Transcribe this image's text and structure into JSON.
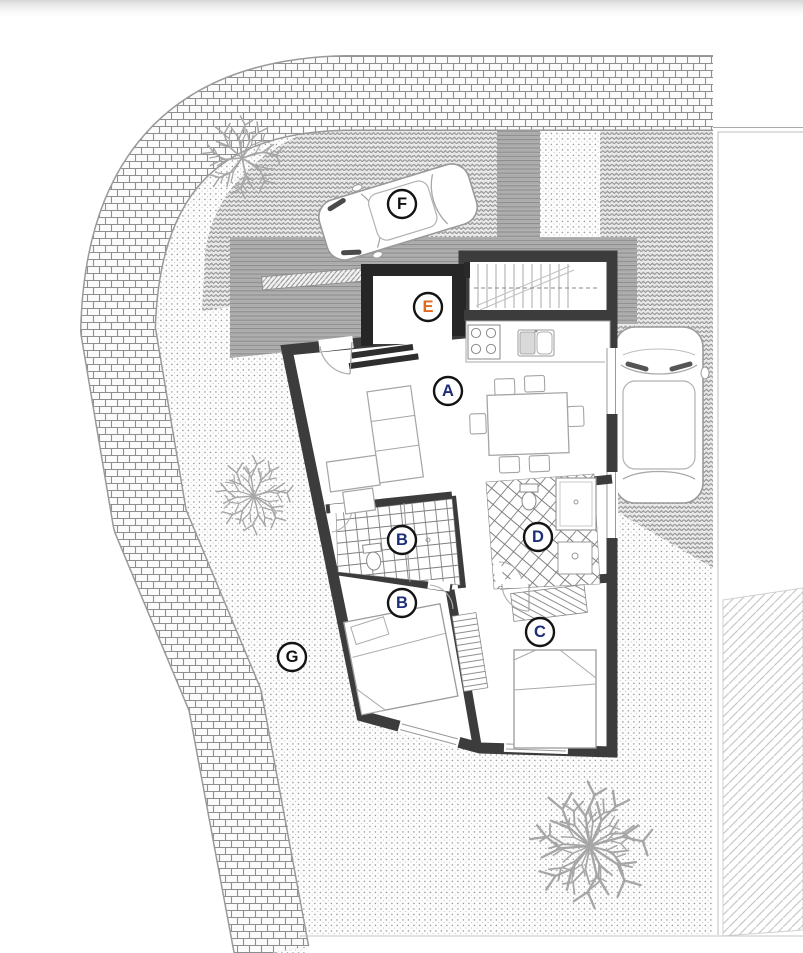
{
  "plan": {
    "labels": [
      {
        "letter": "A",
        "x": 448,
        "y": 391,
        "color": "#1c2e7a"
      },
      {
        "letter": "B",
        "x": 402,
        "y": 540,
        "color": "#1c2e7a"
      },
      {
        "letter": "B",
        "x": 402,
        "y": 603,
        "color": "#1c2e7a"
      },
      {
        "letter": "C",
        "x": 540,
        "y": 632,
        "color": "#1c2e7a"
      },
      {
        "letter": "D",
        "x": 538,
        "y": 537,
        "color": "#1c2e7a"
      },
      {
        "letter": "E",
        "x": 428,
        "y": 307,
        "color": "#e06a1c"
      },
      {
        "letter": "F",
        "x": 402,
        "y": 204,
        "color": "#101010"
      },
      {
        "letter": "G",
        "x": 292,
        "y": 657,
        "color": "#101010"
      }
    ],
    "colors": {
      "wall": "#3c3c3c",
      "wall_dark": "#262626",
      "paving_line": "#8f8f8f",
      "driveway_gray": "#b2b2b2",
      "label_ring": "#141414"
    }
  }
}
